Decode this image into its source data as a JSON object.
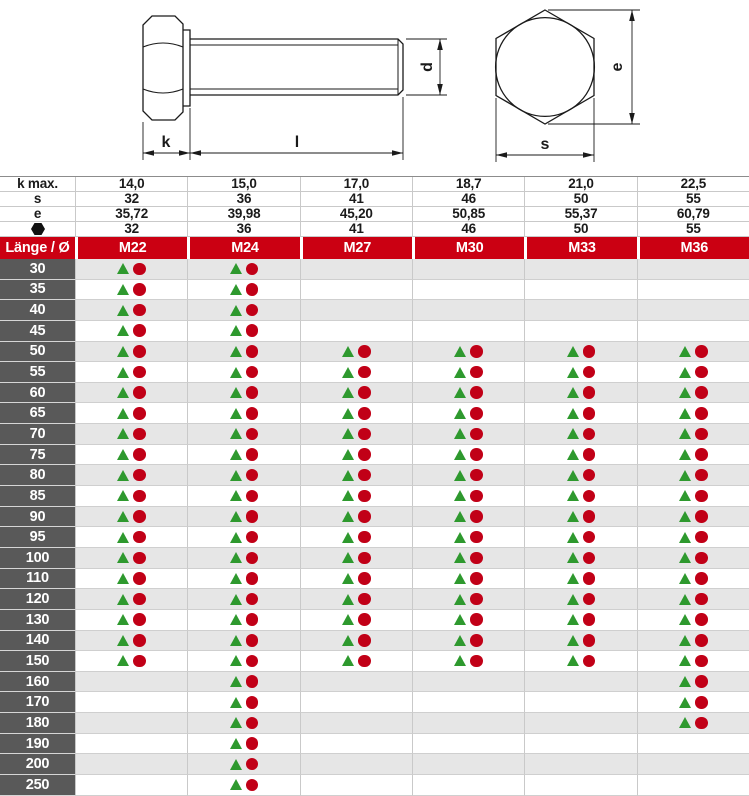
{
  "drawing": {
    "labels": {
      "head_height": "k",
      "shank_length": "l",
      "diameter": "d",
      "across_corners": "e",
      "across_flats": "s"
    }
  },
  "table": {
    "spec_rows": [
      {
        "label": "k max.",
        "icon": false,
        "values": [
          "14,0",
          "15,0",
          "17,0",
          "18,7",
          "21,0",
          "22,5"
        ]
      },
      {
        "label": "s",
        "icon": false,
        "values": [
          "32",
          "36",
          "41",
          "46",
          "50",
          "55"
        ]
      },
      {
        "label": "e",
        "icon": false,
        "values": [
          "35,72",
          "39,98",
          "45,20",
          "50,85",
          "55,37",
          "60,79"
        ]
      },
      {
        "label": "",
        "icon": true,
        "values": [
          "32",
          "36",
          "41",
          "46",
          "50",
          "55"
        ]
      }
    ],
    "header": {
      "label": "Länge / Ø",
      "columns": [
        "M22",
        "M24",
        "M27",
        "M30",
        "M33",
        "M36"
      ]
    },
    "rows": [
      {
        "length": "30",
        "available": [
          1,
          1,
          0,
          0,
          0,
          0
        ]
      },
      {
        "length": "35",
        "available": [
          1,
          1,
          0,
          0,
          0,
          0
        ]
      },
      {
        "length": "40",
        "available": [
          1,
          1,
          0,
          0,
          0,
          0
        ]
      },
      {
        "length": "45",
        "available": [
          1,
          1,
          0,
          0,
          0,
          0
        ]
      },
      {
        "length": "50",
        "available": [
          1,
          1,
          1,
          1,
          1,
          1
        ]
      },
      {
        "length": "55",
        "available": [
          1,
          1,
          1,
          1,
          1,
          1
        ]
      },
      {
        "length": "60",
        "available": [
          1,
          1,
          1,
          1,
          1,
          1
        ]
      },
      {
        "length": "65",
        "available": [
          1,
          1,
          1,
          1,
          1,
          1
        ]
      },
      {
        "length": "70",
        "available": [
          1,
          1,
          1,
          1,
          1,
          1
        ]
      },
      {
        "length": "75",
        "available": [
          1,
          1,
          1,
          1,
          1,
          1
        ]
      },
      {
        "length": "80",
        "available": [
          1,
          1,
          1,
          1,
          1,
          1
        ]
      },
      {
        "length": "85",
        "available": [
          1,
          1,
          1,
          1,
          1,
          1
        ]
      },
      {
        "length": "90",
        "available": [
          1,
          1,
          1,
          1,
          1,
          1
        ]
      },
      {
        "length": "95",
        "available": [
          1,
          1,
          1,
          1,
          1,
          1
        ]
      },
      {
        "length": "100",
        "available": [
          1,
          1,
          1,
          1,
          1,
          1
        ]
      },
      {
        "length": "110",
        "available": [
          1,
          1,
          1,
          1,
          1,
          1
        ]
      },
      {
        "length": "120",
        "available": [
          1,
          1,
          1,
          1,
          1,
          1
        ]
      },
      {
        "length": "130",
        "available": [
          1,
          1,
          1,
          1,
          1,
          1
        ]
      },
      {
        "length": "140",
        "available": [
          1,
          1,
          1,
          1,
          1,
          1
        ]
      },
      {
        "length": "150",
        "available": [
          1,
          1,
          1,
          1,
          1,
          1
        ]
      },
      {
        "length": "160",
        "available": [
          0,
          1,
          0,
          0,
          0,
          1
        ]
      },
      {
        "length": "170",
        "available": [
          0,
          1,
          0,
          0,
          0,
          1
        ]
      },
      {
        "length": "180",
        "available": [
          0,
          1,
          0,
          0,
          0,
          1
        ]
      },
      {
        "length": "190",
        "available": [
          0,
          1,
          0,
          0,
          0,
          0
        ]
      },
      {
        "length": "200",
        "available": [
          0,
          1,
          0,
          0,
          0,
          0
        ]
      },
      {
        "length": "250",
        "available": [
          0,
          1,
          0,
          0,
          0,
          0
        ]
      }
    ]
  },
  "colors": {
    "header_red": "#cb0012",
    "label_grey": "#595959",
    "stripe_grey": "#e6e6e6",
    "triangle_green": "#2e992e",
    "circle_red": "#c10017",
    "line_black": "#1a1a1a"
  }
}
